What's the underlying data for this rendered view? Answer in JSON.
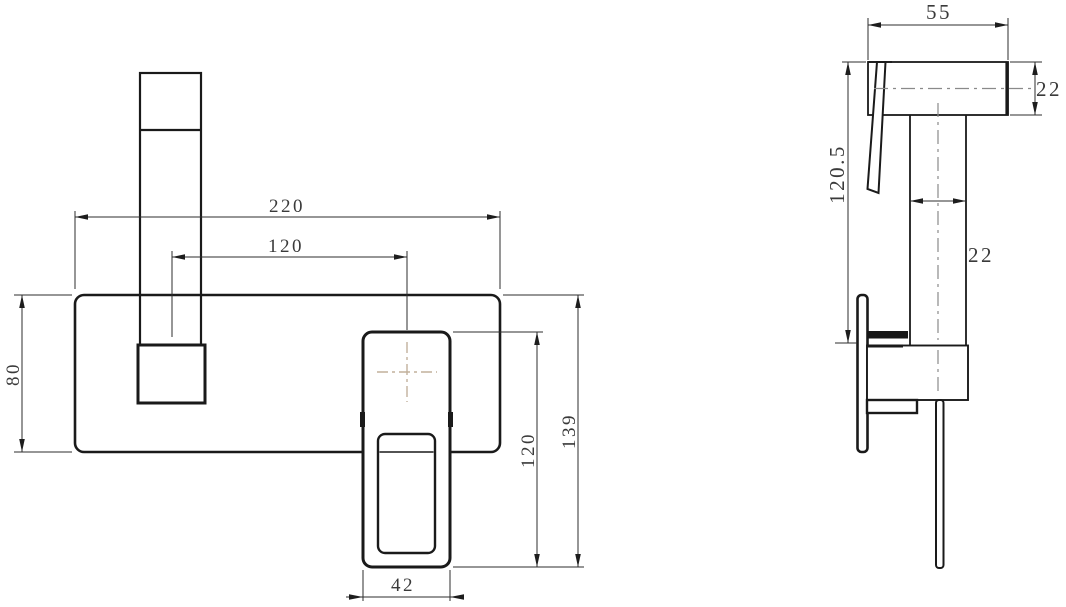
{
  "drawing": {
    "kind": "faucet technical dimension drawing, two orthographic views",
    "front_view": {
      "dimensions": {
        "plate_width": "220",
        "spout_to_handle_spacing": "120",
        "plate_height": "80",
        "handle_height": "120",
        "overall_height": "139",
        "handle_width": "42"
      }
    },
    "side_view": {
      "dimensions": {
        "spout_reach": "55",
        "spout_section_height": "22",
        "overall_depth": "120.5",
        "pipe_section_width": "22"
      }
    },
    "colors": {
      "object_line": "#1a1a1a",
      "dimension_line": "#2e2e2e",
      "centerline": "#8a8a8a",
      "center_cross": "#c2b19c",
      "background": "#ffffff"
    }
  }
}
